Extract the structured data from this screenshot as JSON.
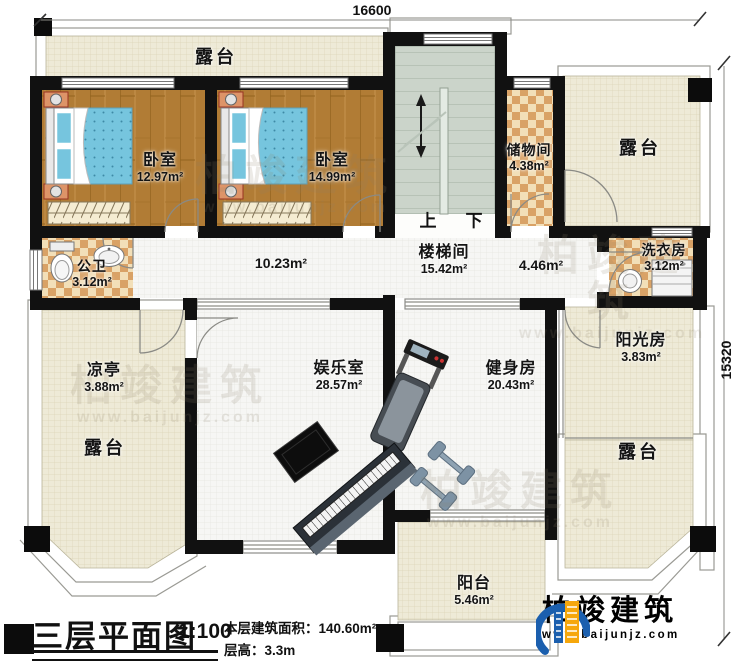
{
  "colors": {
    "wall": "#111111",
    "terrace_floor": "#eeead7",
    "wood_floor": "#b17c35",
    "tile_dark": "#d9a266",
    "tile_light": "#f2dfb8",
    "stair_floor": "#cbd4ca",
    "bed_blue": "#76c5de",
    "logo_blue": "#1b5fae",
    "logo_orange": "#f6a70c"
  },
  "dimensions": {
    "top": "16600",
    "right": "15320"
  },
  "stairs": {
    "up": "上",
    "down": "下"
  },
  "rooms": {
    "terrace_top": {
      "name": "露台"
    },
    "bedroom1": {
      "name": "卧室",
      "area": "12.97m²"
    },
    "bedroom2": {
      "name": "卧室",
      "area": "14.99m²"
    },
    "storage": {
      "name": "储物间",
      "area": "4.38m²"
    },
    "terrace_right_top": {
      "name": "露台"
    },
    "bathroom": {
      "name": "公卫",
      "area": "3.12m²"
    },
    "hall_west": {
      "area": "10.23m²"
    },
    "stairwell": {
      "name": "楼梯间",
      "area": "15.42m²"
    },
    "hall_east": {
      "area": "4.46m²"
    },
    "laundry": {
      "name": "洗衣房",
      "area": "3.12m²"
    },
    "pavilion": {
      "name": "凉亭",
      "area": "3.88m²"
    },
    "terrace_left": {
      "name": "露台"
    },
    "entertainment": {
      "name": "娱乐室",
      "area": "28.57m²"
    },
    "gym": {
      "name": "健身房",
      "area": "20.43m²"
    },
    "sunroom": {
      "name": "阳光房",
      "area": "3.83m²"
    },
    "terrace_right_bottom": {
      "name": "露台"
    },
    "balcony": {
      "name": "阳台",
      "area": "5.46m²"
    }
  },
  "title_block": {
    "title": "三层平面图",
    "scale": "1:100",
    "area_line": "本层建筑面积：140.60m²",
    "height_line": "层高：3.3m"
  },
  "logo": {
    "company": "柏竣建筑",
    "website": "www.baijunjz.com"
  },
  "watermark": {
    "brand": "柏竣建筑",
    "site": "www.baijunjz.com"
  }
}
